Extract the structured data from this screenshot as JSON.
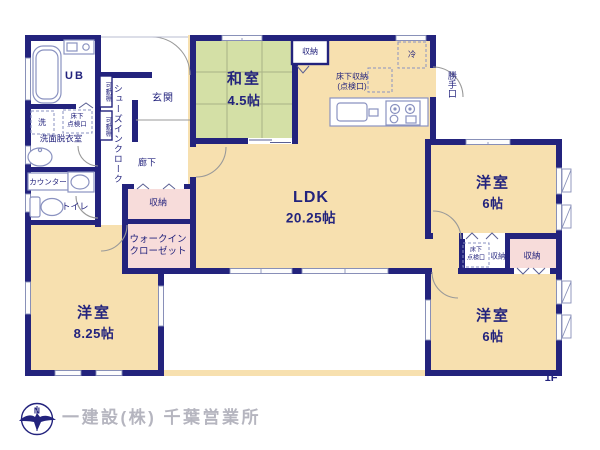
{
  "floor_plan": {
    "floor": "1F",
    "rooms": {
      "washitsu": {
        "name": "和室",
        "size": "4.5帖"
      },
      "ldk": {
        "name": "LDK",
        "size": "20.25帖"
      },
      "bedroom_ne": {
        "name": "洋室",
        "size": "6帖"
      },
      "bedroom_se": {
        "name": "洋室",
        "size": "6帖"
      },
      "bedroom_sw": {
        "name": "洋室",
        "size": "8.25帖"
      },
      "unit_bath": "UB",
      "genkan": "玄関",
      "hallway": "廊下",
      "washroom": "洗面脱衣室",
      "toilet": "トイレ"
    },
    "features": {
      "shoe_closet": "シューズインクローク",
      "movable_shelf": "可動棚",
      "counter": "カウンター",
      "washer": "洗",
      "floor_hatch_l1": "床下",
      "floor_hatch_l2": "点検口",
      "underfloor_storage_l1": "床下収納",
      "underfloor_storage_l2": "(点検口)",
      "refrigerator": "冷",
      "back_door": "勝手口",
      "storage": "収納",
      "walkin_l1": "ウォークイン",
      "walkin_l2": "クローゼット"
    },
    "colors": {
      "wall": "#23237d",
      "room_cream": "#f7e0af",
      "tatami_green": "#d4e0a6",
      "closet_pink": "#f7dcda"
    }
  },
  "footer": {
    "company": "一建設(株) 千葉営業所",
    "compass_north": "N"
  }
}
